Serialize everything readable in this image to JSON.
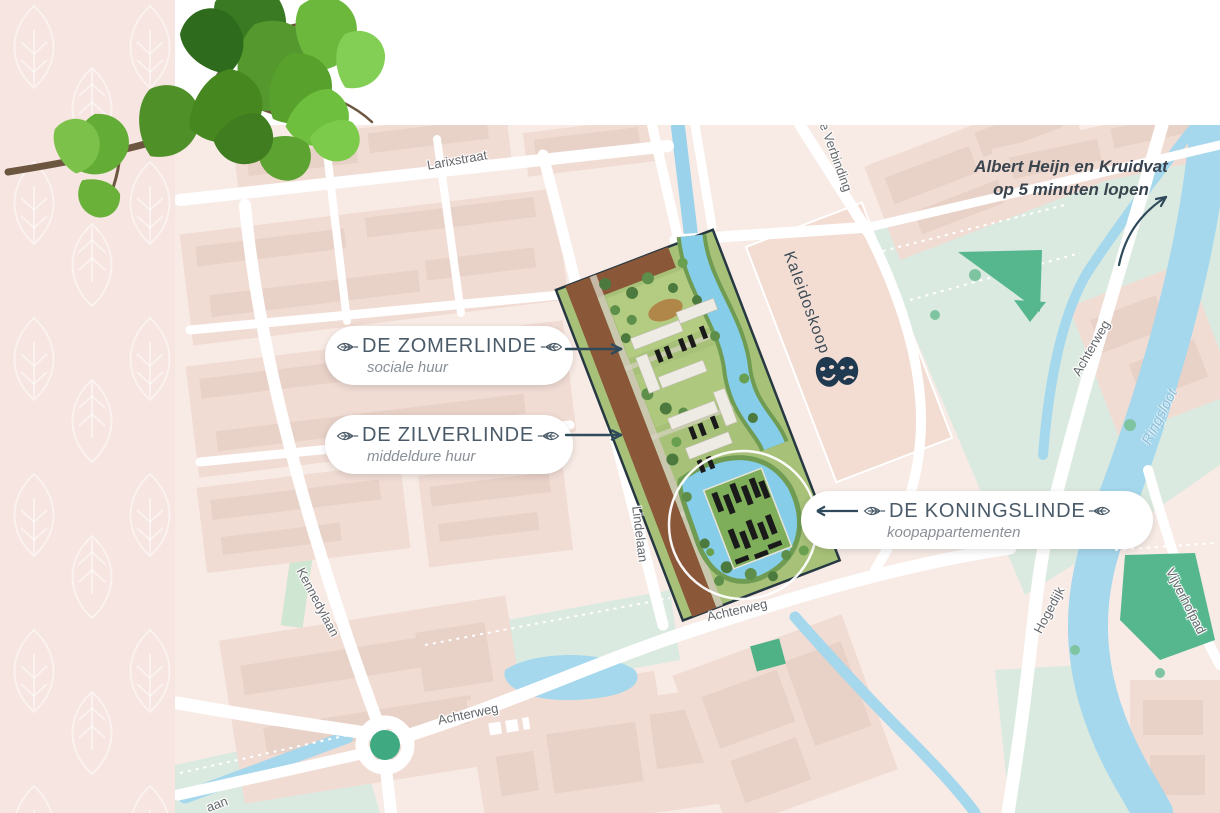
{
  "note": {
    "line1": "Albert Heijn en Kruidvat",
    "line2": "op 5 minuten lopen"
  },
  "pills": [
    {
      "title": "DE ZOMERLINDE",
      "subtitle": "sociale huur",
      "arrow": "right"
    },
    {
      "title": "DE ZILVERLINDE",
      "subtitle": "middeldure huur",
      "arrow": "right"
    },
    {
      "title": "DE KONINGSLINDE",
      "subtitle": "koopappartementen",
      "arrow": "left"
    }
  ],
  "venue": {
    "name": "Kaleidoskoop",
    "icon": "theater-masks-icon"
  },
  "streets": [
    {
      "text": "Larixstraat"
    },
    {
      "text": "e Verbinding"
    },
    {
      "text": "Kennedylaan"
    },
    {
      "text": "Lindelaan"
    },
    {
      "text": "Achterweg"
    },
    {
      "text": "Achterweg"
    },
    {
      "text": "Achterweg"
    },
    {
      "text": "Hogedijk"
    },
    {
      "text": "Vijverhofpad"
    },
    {
      "text": "Ringsloot"
    },
    {
      "text": "aan"
    }
  ],
  "icons": {
    "pill_leaf": "linden-leaf-outline-icon",
    "venue": "theater-masks-icon",
    "arrows": "direction-arrow-icon",
    "panel_pattern": "leaf-outline-pattern",
    "branch": "linden-branch-photo"
  },
  "colors": {
    "panel_pink": "#f6e5e0",
    "map_base": "#f8ebe5",
    "block_pink": "#f1dcd4",
    "building_pink": "#e8d1c7",
    "mint_green": "#dbeae0",
    "park_green": "#56b78e",
    "park_dark": "#3fa982",
    "water_blue": "#a5d7ed",
    "site_water": "#85cde9",
    "site_lawn": "#a7c178",
    "site_bank_green": "#6f9c52",
    "site_path_brown": "#8a5738",
    "roof_white": "#edebe3",
    "solar_black": "#1a1a1a",
    "site_outline": "#263842",
    "road_white": "#ffffff",
    "title_slate": "#4a5a68",
    "subtitle_gray": "#8a9097",
    "arrow_navy": "#2f4a5a",
    "note_text": "#39444e",
    "street_label": "#64686c",
    "water_label": "#8fc0d8",
    "venue_label": "#3f4b52",
    "mask_navy": "#1e3950",
    "leaf_green": "#57a02e",
    "branch_brown": "#6d5640"
  }
}
